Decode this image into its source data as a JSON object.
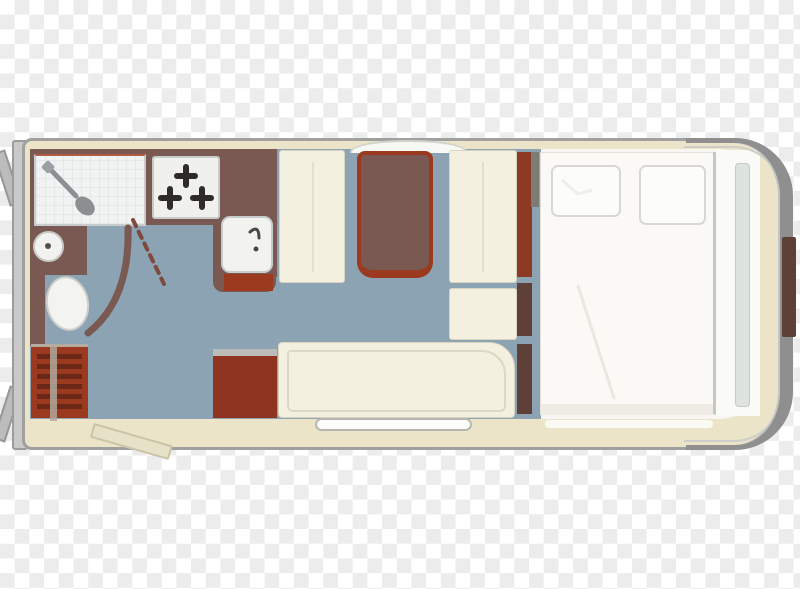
{
  "meta": {
    "description": "Top-view floor plan of a caravan interior rendered on a transparent checkerboard background",
    "visible_text": "none"
  },
  "palette": {
    "checker_light": "#ffffff",
    "checker_dark": "#ececec",
    "floor": "#8ba3b3",
    "outer_wall": "#ebe4c8",
    "outline": "#a0a0a0",
    "interior_wall": "#7a5952",
    "accent_rust": "#9c3a1f",
    "cube_red": "#8e3420",
    "furniture_cream": "#f4f0df",
    "bed_white": "#faf9f5",
    "shell_gray": "#8f8f8f",
    "locker_brown": "#5c4037",
    "burner_dark": "#2e2b28"
  },
  "rooms": {
    "bathroom": {
      "features": [
        "shower-cubicle",
        "shower-head",
        "washbasin",
        "toilet",
        "door-swing-arc",
        "curved-partition-wall",
        "drawer-cabinet"
      ]
    },
    "kitchen": {
      "features": [
        "three-burner-hob",
        "sink-with-faucet",
        "worktop"
      ]
    },
    "lounge": {
      "features": [
        "dinette-table",
        "bench-seat-left",
        "bench-seat-right",
        "side-cabinet",
        "l-shaped-sofa",
        "storage-cube"
      ]
    },
    "bedroom": {
      "features": [
        "double-bed",
        "pillow-left",
        "pillow-right",
        "wardrobe-strips"
      ]
    },
    "exterior": {
      "features": [
        "rear-bumper",
        "corner-steady-top",
        "corner-steady-bottom",
        "entry-door",
        "entry-step",
        "roof-window",
        "front-shell",
        "front-locker"
      ]
    }
  },
  "counts": {
    "hob_burners": 3,
    "pillows": 2,
    "dinette_benches": 2
  }
}
